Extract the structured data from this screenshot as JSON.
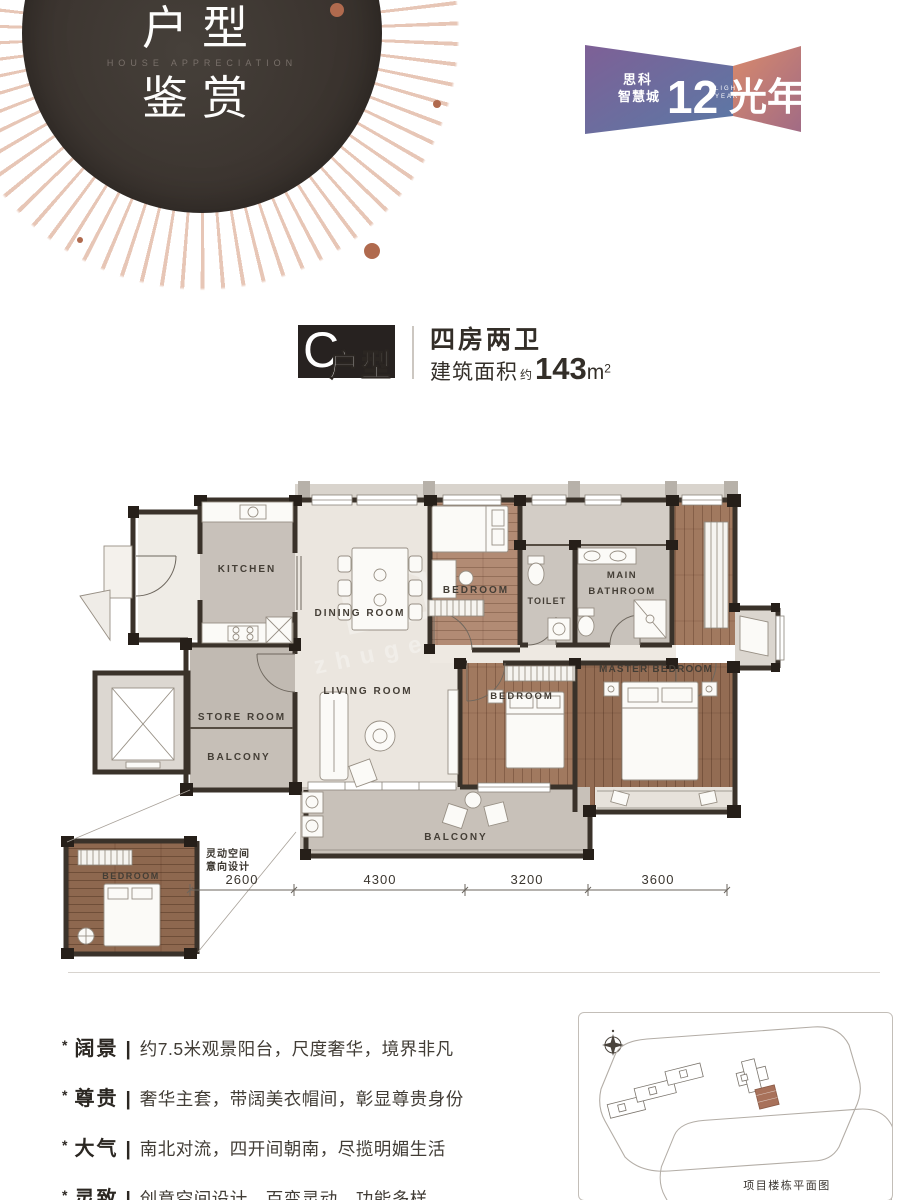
{
  "hero": {
    "title_line1": "户型",
    "title_line2": "鉴赏",
    "subtitle": "HOUSE APPRECIATION"
  },
  "logo": {
    "brand_line1": "思科",
    "brand_line2": "智慧城",
    "numeral": "12",
    "name_cn": "光年",
    "name_en_line1": "LIGHT",
    "name_en_line2": "YEAR"
  },
  "unit": {
    "letter": "C",
    "letter_suffix": "户型",
    "layout": "四房两卫",
    "area_label": "建筑面积",
    "area_approx": "约",
    "area_value": "143",
    "area_unit_base": "m",
    "area_unit_sup": "2"
  },
  "floorplan": {
    "rooms": {
      "kitchen": "KITCHEN",
      "dining": "DINING ROOM",
      "bedroom_top": "BEDROOM",
      "toilet": "TOILET",
      "main_bath_line1": "MAIN",
      "main_bath_line2": "BATHROOM",
      "living": "LIVING ROOM",
      "store": "STORE ROOM",
      "balcony_left": "BALCONY",
      "bedroom_mid": "BEDROOM",
      "master": "MASTER BEDROOM",
      "balcony_bottom": "BALCONY",
      "inset_bedroom": "BEDROOM"
    },
    "inset_note_line1": "灵动空间",
    "inset_note_line2": "意向设计",
    "dimensions": [
      "2600",
      "4300",
      "3200",
      "3600"
    ],
    "watermark": "zhuge"
  },
  "features": [
    {
      "term": "阔景",
      "divider": "|",
      "desc": "约7.5米观景阳台，尺度奢华，境界非凡"
    },
    {
      "term": "尊贵",
      "divider": "|",
      "desc": "奢华主套，带阔美衣帽间，彰显尊贵身份"
    },
    {
      "term": "大气",
      "divider": "|",
      "desc": "南北对流，四开间朝南，尽揽明媚生活"
    },
    {
      "term": "灵致",
      "divider": "|",
      "desc": "创意空间设计，百变灵动，功能多样"
    }
  ],
  "site_plan": {
    "caption": "项目楼栋平面图"
  },
  "palette": {
    "accent_copper": "#b06a4e",
    "wall_dark": "#3a322a",
    "logo_purple": "#7e6096",
    "logo_blue": "#5a79a6",
    "logo_coral": "#d98a6b"
  }
}
